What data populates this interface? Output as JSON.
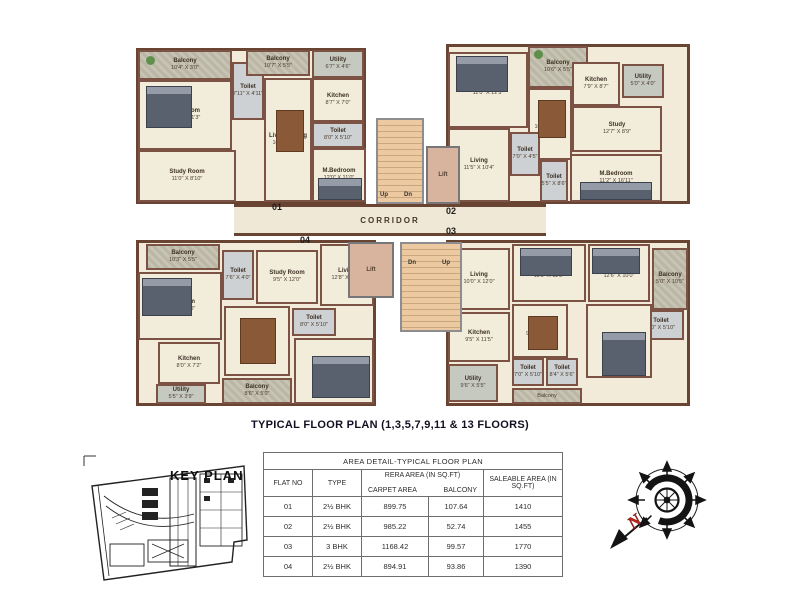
{
  "page": {
    "title": "TYPICAL FLOOR PLAN (1,3,5,7,9,11 & 13 FLOORS)"
  },
  "plan": {
    "corridor": "CORRIDOR",
    "core": {
      "lift": "Lift",
      "up": "Up",
      "dn": "Dn"
    },
    "units": {
      "u01": {
        "number": "01",
        "rooms": [
          {
            "name": "Balcony",
            "dims": "10'4\" X 3'0\""
          },
          {
            "name": "Bed Room",
            "dims": "10'4\" X 11'3\""
          },
          {
            "name": "Study Room",
            "dims": "11'0\" X 8'10\""
          },
          {
            "name": "Toilet",
            "dims": "7'11\" X 4'11\""
          },
          {
            "name": "Balcony",
            "dims": "10'7\" X 5'5\""
          },
          {
            "name": "Utility",
            "dims": "6'7\" X 4'6\""
          },
          {
            "name": "Kitchen",
            "dims": "8'7\" X 7'0\""
          },
          {
            "name": "Toilet",
            "dims": "8'0\" X 5'10\""
          },
          {
            "name": "Living/Dining",
            "dims": "10'7\" X 24'2\""
          },
          {
            "name": "M.Bedroom",
            "dims": "12'0\" X 11'0\""
          }
        ]
      },
      "u02": {
        "number": "02",
        "rooms": [
          {
            "name": "Bedroom",
            "dims": "11'0\" X 12'3\""
          },
          {
            "name": "Balcony",
            "dims": "10'6\" X 5'5\""
          },
          {
            "name": "Kitchen",
            "dims": "7'9\" X 8'7\""
          },
          {
            "name": "Utility",
            "dims": "5'0\" X 4'0\""
          },
          {
            "name": "Dining",
            "dims": "10'6\" X 12'6\""
          },
          {
            "name": "Study",
            "dims": "12'7\" X 8'9\""
          },
          {
            "name": "Living",
            "dims": "11'5\" X 10'4\""
          },
          {
            "name": "Toilet",
            "dims": "7'0\" X 4'5\""
          },
          {
            "name": "Toilet",
            "dims": "5'5\" X 8'6\""
          },
          {
            "name": "M.Bedroom",
            "dims": "11'2\" X 16'11\""
          }
        ]
      },
      "u03": {
        "number": "03",
        "rooms": [
          {
            "name": "Living",
            "dims": "10'0\" X 12'0\""
          },
          {
            "name": "Bedroom",
            "dims": "11'5\" X 11'5\""
          },
          {
            "name": "Bedroom",
            "dims": "12'6\" X 10'0\""
          },
          {
            "name": "Balcony",
            "dims": "5'0\" X 10'5\""
          },
          {
            "name": "Toilet",
            "dims": "8'0\" X 5'10\""
          },
          {
            "name": "Dining",
            "dims": "9'5\" X 10'6\""
          },
          {
            "name": "Kitchen",
            "dims": "9'5\" X 11'5\""
          },
          {
            "name": "M.Bedroom",
            "dims": "12'7\" X 12'5\""
          },
          {
            "name": "Toilet",
            "dims": "7'0\" X 5'10\""
          },
          {
            "name": "Toilet",
            "dims": "8'4\" X 5'6\""
          },
          {
            "name": "Utility",
            "dims": "9'6\" X 5'5\""
          },
          {
            "name": "Balcony",
            "dims": "9'5\" X 5'5\""
          }
        ]
      },
      "u04": {
        "number": "04",
        "rooms": [
          {
            "name": "Balcony",
            "dims": "10'3\" X 5'5\""
          },
          {
            "name": "Toilet",
            "dims": "7'6\" X 4'0\""
          },
          {
            "name": "Bed Room",
            "dims": "10'8\" X 11'0\""
          },
          {
            "name": "Study Room",
            "dims": "9'5\" X 12'0\""
          },
          {
            "name": "Living",
            "dims": "12'8\" X 12'7\""
          },
          {
            "name": "Dining"
          },
          {
            "name": "Toilet",
            "dims": "8'0\" X 5'10\""
          },
          {
            "name": "Kitchen",
            "dims": "8'0\" X 7'2\""
          },
          {
            "name": "Utility",
            "dims": "5'5\" X 3'9\""
          },
          {
            "name": "Balcony",
            "dims": "8'6\" X 5'0\""
          },
          {
            "name": "M.Bedroom",
            "dims": "12'8\" X 11'9\""
          }
        ]
      }
    }
  },
  "key_plan": {
    "label": "KEY PLAN"
  },
  "area_table": {
    "title": "AREA DETAIL-TYPICAL FLOOR PLAN",
    "headers": {
      "flat": "FLAT NO",
      "type": "TYPE",
      "rera": "RERA AREA  (IN SQ.FT)",
      "carpet": "CARPET AREA",
      "balcony": "BALCONY",
      "saleable": "SALEABLE AREA (IN SQ.FT)"
    },
    "rows": [
      {
        "flat": "01",
        "type": "2½ BHK",
        "carpet": "899.75",
        "balcony": "107.64",
        "saleable": "1410"
      },
      {
        "flat": "02",
        "type": "2½ BHK",
        "carpet": "985.22",
        "balcony": "52.74",
        "saleable": "1455"
      },
      {
        "flat": "03",
        "type": "3 BHK",
        "carpet": "1168.42",
        "balcony": "99.57",
        "saleable": "1770"
      },
      {
        "flat": "04",
        "type": "2½ BHK",
        "carpet": "894.91",
        "balcony": "93.86",
        "saleable": "1390"
      }
    ]
  },
  "compass": {
    "north": "N"
  },
  "colors": {
    "wall": "#6a4433",
    "floor": "#f2ebd9",
    "north_red": "#c3271b"
  }
}
